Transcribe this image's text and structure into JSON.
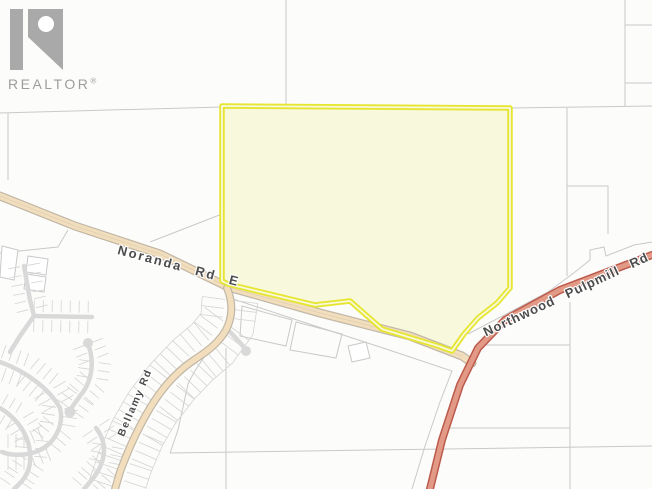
{
  "branding": {
    "name": "REALTOR",
    "registered": "®"
  },
  "map": {
    "road_labels": {
      "noranda": "Noranda Rd E",
      "northwood": "Northwood Pulpmill Rd",
      "bellamy": "Bellamy Rd"
    },
    "colors": {
      "background": "#fcfcfa",
      "parcel_line": "#c9c9c9",
      "local_road": "#d9d9d9",
      "minor_road_fill": "#f2debc",
      "minor_road_casing": "#c2b8a8",
      "major_road_fill": "#e29a86",
      "major_road_casing": "#bc5a4c",
      "property_fill": "#f8f8dd",
      "property_stroke": "#e6e632",
      "label_text": "#4c4c4c",
      "logo_gray": "#a9a9a9"
    }
  }
}
